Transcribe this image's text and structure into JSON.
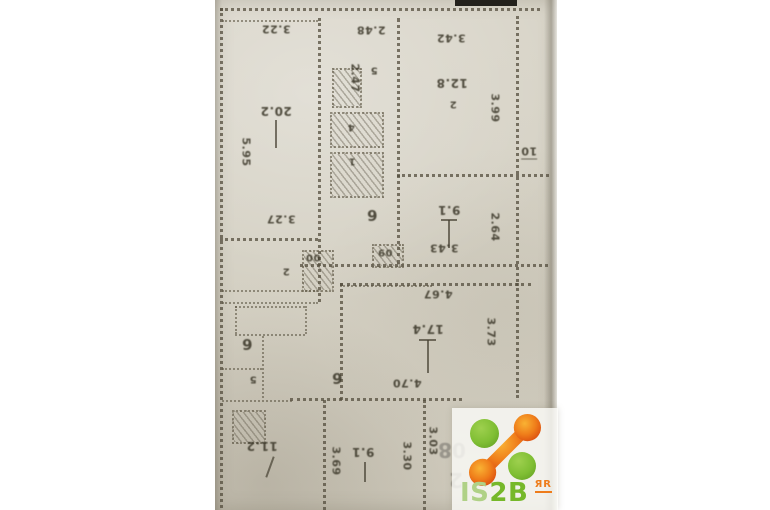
{
  "scan": {
    "rooms": {
      "living": {
        "area": "20.2",
        "dim_top": "3.22",
        "dim_left": "5.95",
        "dim_bottom": "3.27"
      },
      "bedroom": {
        "area": "12.8",
        "number": "2",
        "dim_top": "3.42",
        "dim_side": "3.99"
      },
      "mid": {
        "area": "9.1",
        "dim_bottom": "3.43",
        "dim_side": "2.64"
      },
      "kitchen": {
        "area": "2.47",
        "dim_top": "2.48",
        "number": "5"
      },
      "hall": {
        "area": "17.4",
        "dim_top": "4.67",
        "dim_side": "3.73",
        "dim_bottom": "4.70"
      },
      "lower": {
        "area": "9.1",
        "dim_left": "3.69",
        "dim_right": "3.30",
        "dim_far": "3.03"
      },
      "corner": {
        "area": "11.2"
      }
    },
    "markers": {
      "floor": "10",
      "k5": "5",
      "k4": "4",
      "k1": "1",
      "c6": "6",
      "c00": "00",
      "c09": "09",
      "c2": "2",
      "b6": "6",
      "b5": "5",
      "h6": "6"
    },
    "bleed": {
      "top": "08",
      "bottom": "2"
    }
  },
  "watermark": {
    "prefix": "IS",
    "suffix": "2B",
    "badge": "ЯR"
  },
  "colors": {
    "green": "#76b82a",
    "light_green": "#b0d186",
    "orange": "#ee7c1b",
    "paper": "#d7d3c7"
  }
}
